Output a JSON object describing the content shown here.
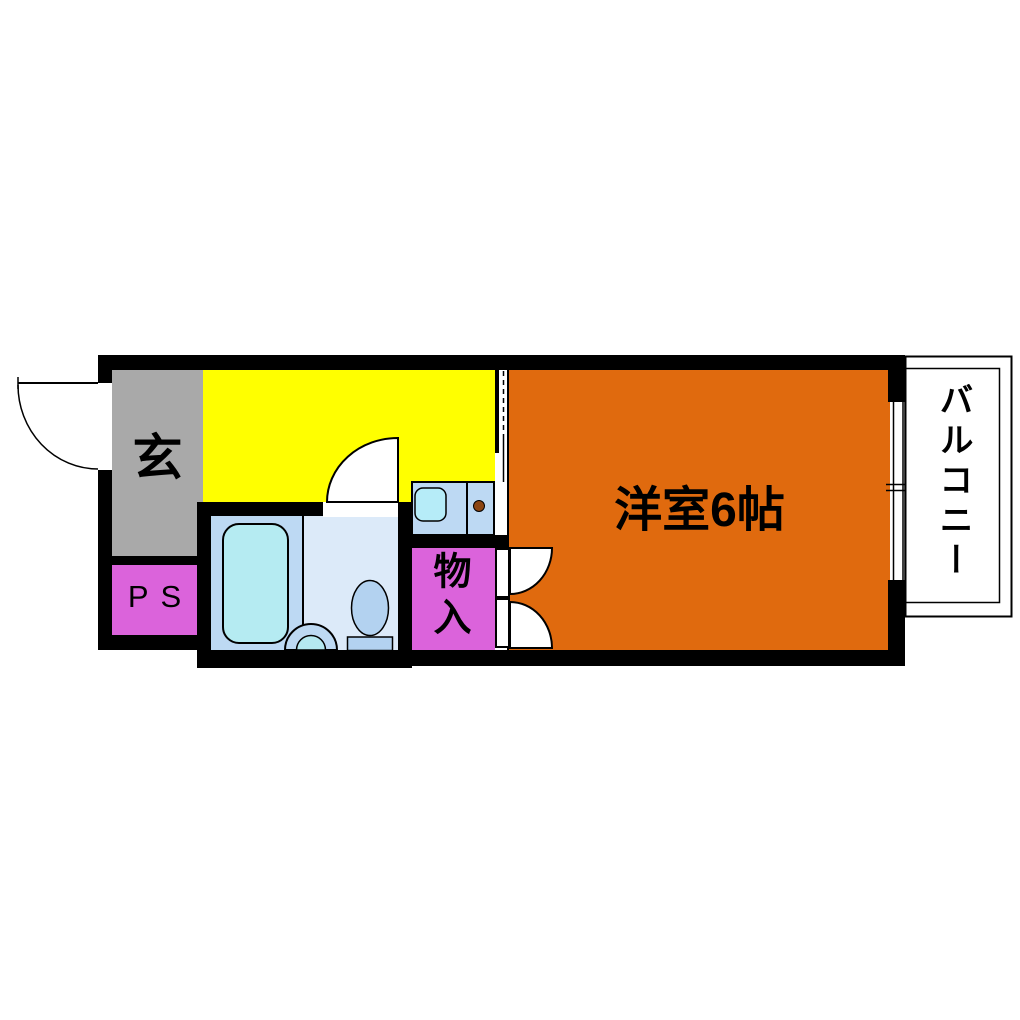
{
  "floorplan": {
    "labels": {
      "genkan": "玄",
      "pipe_space": "PS",
      "storage": "物入",
      "western_room": "洋室6帖",
      "balcony": "バルコニー"
    },
    "colors": {
      "wall": "#000000",
      "genkan": "#A9A9A9",
      "kitchen": "#FFFF00",
      "pipe_space": "#DB63DB",
      "storage": "#DB63DB",
      "western_room": "#E06A0E",
      "bath_left_panel": "#BDD9F3",
      "bath_right_panel": "#DCEAF9",
      "bathtub": "#B5EBF2",
      "counter": "#BDD9F3",
      "sink": "#B6ECF8",
      "toilet": "#B3D2F0",
      "basin_outer": "#BDD9F3",
      "basin_inner": "#B5E8F0",
      "burner": "#8B4513",
      "door": "#FFFFFF"
    }
  }
}
